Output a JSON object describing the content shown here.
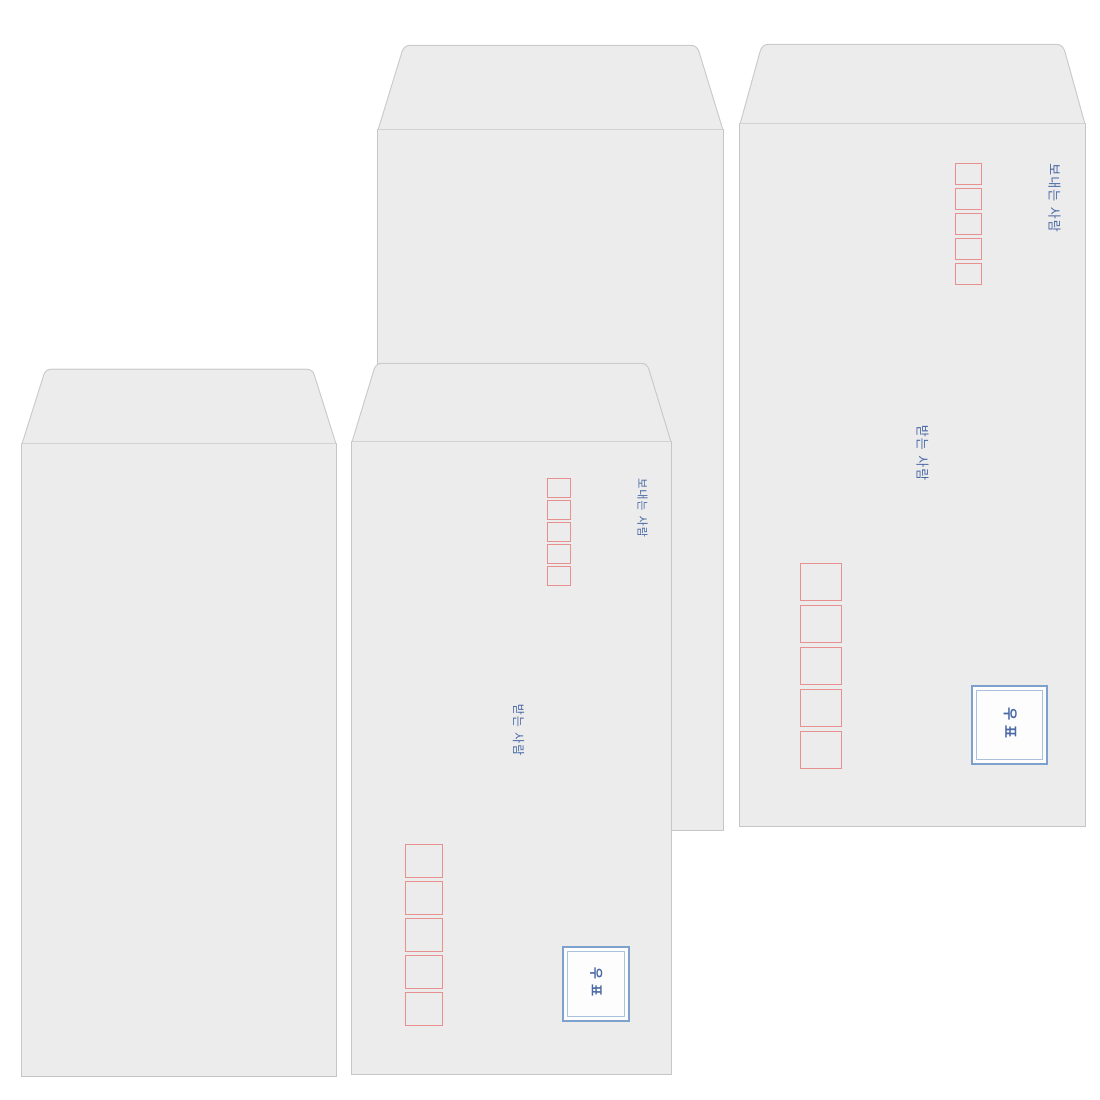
{
  "labels": {
    "sender": "보내는 사람",
    "recipient": "받는 사람",
    "stamp": "우표"
  },
  "postal_boxes": {
    "count": 5
  },
  "envelopes": [
    {
      "name": "left-envelope",
      "side": "back",
      "printed": false
    },
    {
      "name": "middle-back-envelope",
      "side": "back",
      "printed": false
    },
    {
      "name": "middle-front-envelope",
      "side": "front",
      "printed": true
    },
    {
      "name": "right-front-envelope",
      "side": "front",
      "printed": true
    }
  ],
  "colors": {
    "background": "#ffffff",
    "envelope_fill": "#ececec",
    "envelope_border": "#c6c6c6",
    "fold_line": "#d2d2d2",
    "postal_box_red": "#e88f8f",
    "label_blue": "#4a69a5",
    "stamp_border_blue": "#7da0cc",
    "stamp_inner_line": "#aac1de",
    "stamp_fill": "#fdfdfe"
  }
}
